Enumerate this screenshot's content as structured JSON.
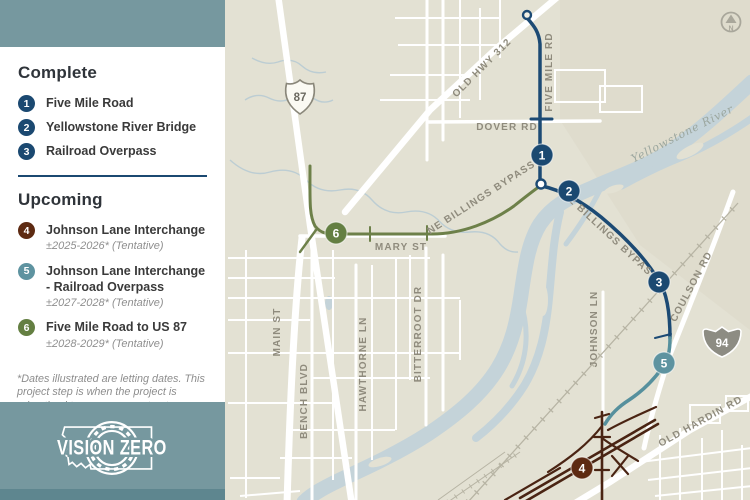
{
  "panel": {
    "complete_title": "Complete",
    "complete_items": [
      {
        "num": "1",
        "label": "Five Mile Road"
      },
      {
        "num": "2",
        "label": "Yellowstone River Bridge"
      },
      {
        "num": "3",
        "label": "Railroad Overpass"
      }
    ],
    "upcoming_title": "Upcoming",
    "upcoming_items": [
      {
        "num": "4",
        "label": "Johnson Lane Interchange",
        "dates": "±2025-2026* (Tentative)"
      },
      {
        "num": "5",
        "label": "Johnson Lane Interchange - Railroad Overpass",
        "dates": "±2027-2028* (Tentative)"
      },
      {
        "num": "6",
        "label": "Five Mile Road to US 87",
        "dates": "±2028-2029* (Tentative)"
      }
    ],
    "footnote": "*Dates illustrated are letting dates. This project step is when the project is advertised to engage a contractor. Based on project dynamics, these dates are subject to change.",
    "logo_text": "VISION ZERO"
  },
  "map": {
    "markers": [
      {
        "num": "1"
      },
      {
        "num": "2"
      },
      {
        "num": "3"
      },
      {
        "num": "4"
      },
      {
        "num": "5"
      },
      {
        "num": "6"
      }
    ],
    "labels": {
      "old_hwy_312": "OLD HWY 312",
      "dover_rd": "DOVER RD",
      "five_mile_rd": "FIVE MILE RD",
      "ne_billings_bypass_w": "NE BILLINGS BYPASS",
      "ne_billings_bypass_e": "NE BILLINGS BYPASS",
      "mary_st": "MARY ST",
      "main_st": "MAIN ST",
      "bench_blvd": "BENCH BLVD",
      "hawthorne_ln": "HAWTHORNE LN",
      "bitterroot_dr": "BITTERROOT DR",
      "johnson_ln": "JOHNSON LN",
      "coulson_rd": "COULSON RD",
      "old_hardin_rd": "OLD HARDIN RD",
      "yellowstone_river": "Yellowstone River"
    },
    "shields": {
      "us87": "87",
      "i94": "94"
    },
    "north_label": "N"
  },
  "colors": {
    "navy": "#1b4971",
    "brown_marker": "#5d2a12",
    "brown_line": "#4a2413",
    "teal_marker": "#5e93a0",
    "teal_line": "#56909d",
    "green": "#647f42",
    "panel_teal": "#76989f",
    "map_bg": "#e3e1d3",
    "river": "#c4d3d9"
  }
}
